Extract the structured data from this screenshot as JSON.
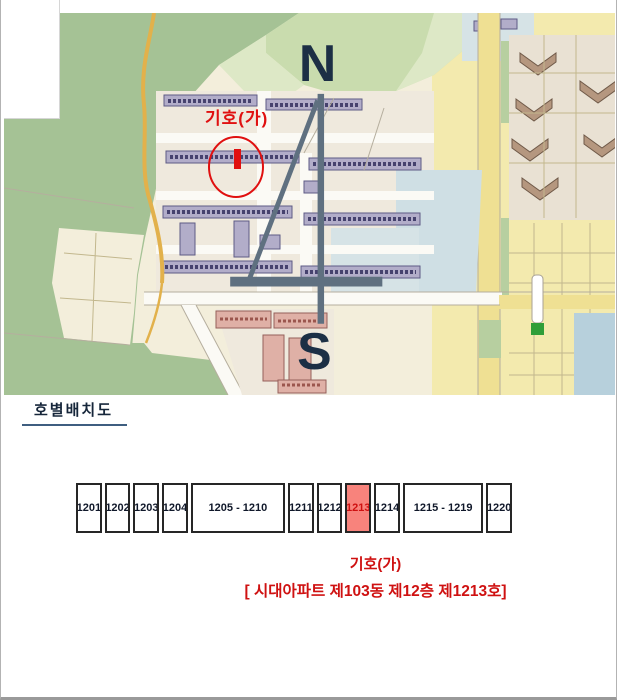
{
  "map": {
    "marker_label": "기호(가)",
    "compass": {
      "north": "N",
      "south": "S"
    }
  },
  "layout_plan": {
    "title": "호별배치도",
    "units": [
      {
        "label": "1201",
        "span": 1
      },
      {
        "label": "1202",
        "span": 1
      },
      {
        "label": "1203",
        "span": 1
      },
      {
        "label": "1204",
        "span": 1
      },
      {
        "label": "1205 - 1210",
        "span": 6
      },
      {
        "label": "1211",
        "span": 1
      },
      {
        "label": "1212",
        "span": 1
      },
      {
        "label": "1213",
        "span": 1,
        "highlight": true
      },
      {
        "label": "1214",
        "span": 1
      },
      {
        "label": "1215 - 1219",
        "span": 5
      },
      {
        "label": "1220",
        "span": 1
      }
    ],
    "caption_symbol": "기호(가)",
    "caption_detail": "[ 시대아파트 제103동 제12층 제1213호]"
  },
  "colors": {
    "page-border": "#b3b3b3",
    "map-cream": "#f3eedb",
    "map-forest": "#a5c295",
    "map-forest-mid": "#b7cfa0",
    "map-field": "#c9dcae",
    "map-pale": "#dde8c6",
    "map-yellow": "#f3eaae",
    "map-yellow-road": "#efe093",
    "map-orange-road": "#e2b14b",
    "map-beige": "#e9e1d3",
    "map-ground": "#efe9dd",
    "map-blue": "#cfdfe4",
    "map-blue2": "#d6e3e6",
    "map-water": "#b7d0dc",
    "map-building": "#b2adc9",
    "map-building-edge": "#5e5a85",
    "map-building-text": "#322f5e",
    "map-pink": "#dfb0a6",
    "map-pink-edge": "#96605a",
    "map-brown": "#b5977f",
    "map-brown-edge": "#6f5948",
    "map-line": "#c2b78d",
    "map-gray-line": "#b5ae9e",
    "map-green-sign": "#2f9e38",
    "annotation-red": "#e01010",
    "compass-line": "#5f7080",
    "compass-text": "#1c2f45",
    "heading-text": "#16263a",
    "heading-underline": "#3f5e80",
    "unit-border": "#262626",
    "unit-text": "#10182a",
    "highlight-fill": "#f8837c",
    "highlight-text": "#cf1111",
    "caption-red": "#cf1111"
  }
}
